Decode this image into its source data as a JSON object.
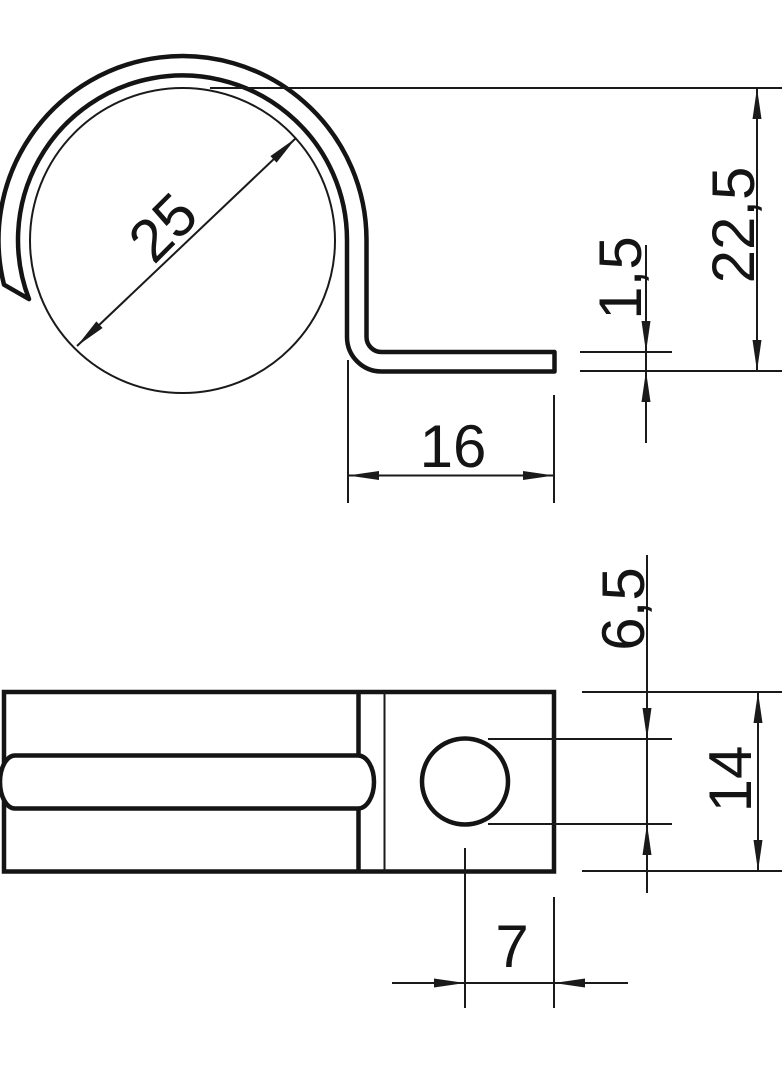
{
  "colors": {
    "background": "#ffffff",
    "line": "#141414"
  },
  "top_view": {
    "dim_clamp_diameter": "25",
    "dim_total_height": "22,5",
    "dim_material_thickness": "1,5",
    "dim_foot_length": "16"
  },
  "bottom_view": {
    "dim_hole_diameter": "6,5",
    "dim_base_width": "14",
    "dim_hole_edge_offset": "7"
  }
}
